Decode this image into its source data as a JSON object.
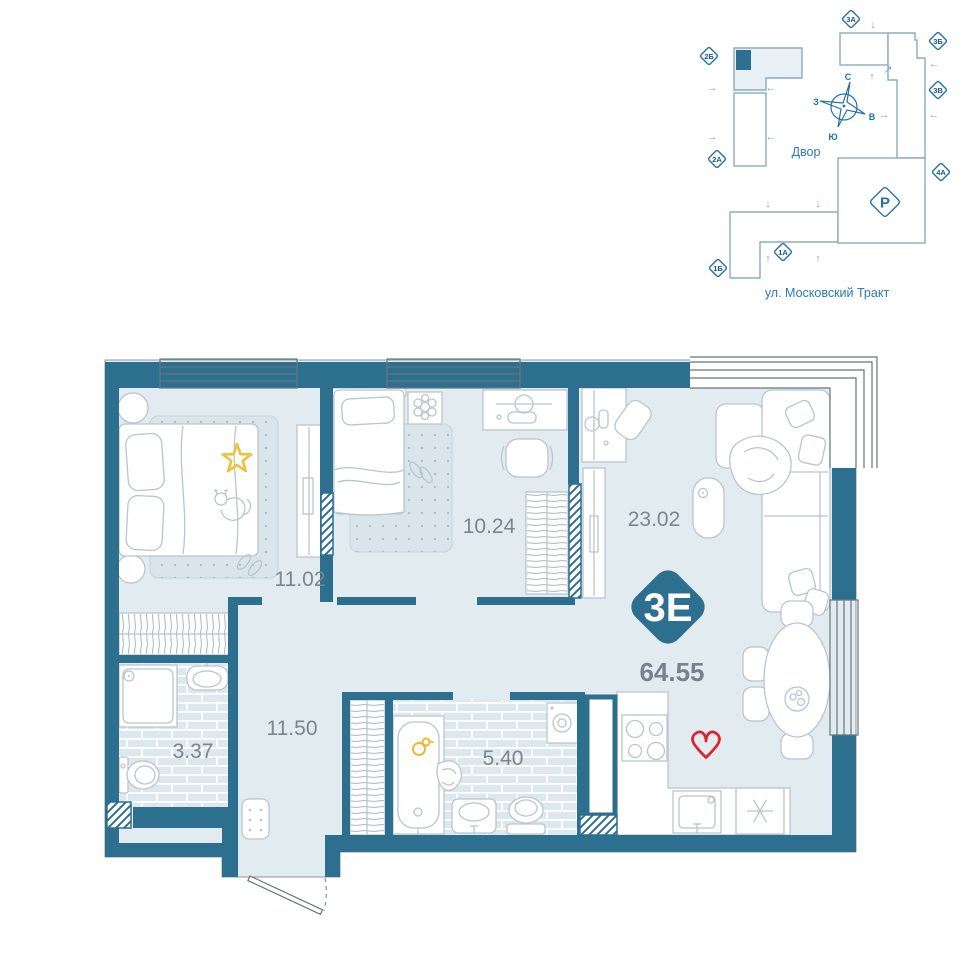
{
  "floor_plan": {
    "unit_badge": "3Е",
    "total_area": "64.55",
    "rooms": [
      {
        "id": "bedroom-1",
        "area": "11.02"
      },
      {
        "id": "bedroom-2",
        "area": "10.24"
      },
      {
        "id": "living-kitchen",
        "area": "23.02"
      },
      {
        "id": "hallway",
        "area": "11.50"
      },
      {
        "id": "bathroom-shower",
        "area": "3.37"
      },
      {
        "id": "bathroom-main",
        "area": "5.40"
      }
    ]
  },
  "site_plan": {
    "courtyard_label": "Двор",
    "street_label": "ул. Московский Тракт",
    "parking_label": "Р",
    "compass": {
      "north": "С",
      "south": "Ю",
      "west": "З",
      "east": "В"
    },
    "building_badges": [
      "2Б",
      "2А",
      "1Б",
      "1А",
      "3А",
      "3Б",
      "3В",
      "4А"
    ],
    "icons": {
      "arrow_right": "→",
      "arrow_left": "←",
      "arrow_up": "↑",
      "arrow_down": "↓",
      "arrow_up_right": "↗"
    }
  },
  "colors": {
    "wall": "#2d6f8f",
    "floor": "#e1ebf0",
    "accent_blue": "#2470ad",
    "site_text_blue": "#2b7ab8",
    "label_gray": "#7b858b",
    "area_gray": "#78828a",
    "star_yellow": "#eec23d",
    "duck_yellow": "#efb733",
    "heart_red": "#e0202f"
  }
}
